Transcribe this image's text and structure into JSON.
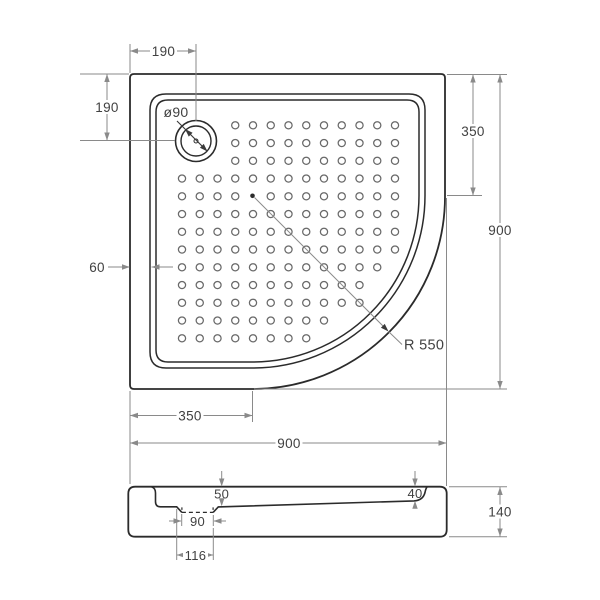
{
  "colors": {
    "background": "#ffffff",
    "object_line": "#2b2b2b",
    "dimension_line": "#8a8a8a",
    "text": "#414141",
    "dot_outline": "#696969"
  },
  "top_view": {
    "dim_top_offset": "190",
    "dim_left_offset": "190",
    "drain_label": "ø90",
    "dim_right_segment": "350",
    "dim_right_total": "900",
    "dim_rim_width": "60",
    "corner_radius_label": "R 550",
    "dim_bottom_segment": "350",
    "dim_bottom_total": "900"
  },
  "section_view": {
    "dim_depth_at_drain": "50",
    "dim_depth_at_edge": "40",
    "dim_recess_width": "90",
    "dim_recess_offset": "116",
    "dim_height": "140"
  },
  "dots": {
    "cols": 13,
    "rows": 13,
    "spacing": 17.75,
    "origin_x": 182,
    "origin_y": 125.3,
    "drain_skip_cols": 3,
    "drain_skip_rows": 3,
    "corner_center_x": 252.5,
    "corner_center_y": 195.5,
    "corner_clip_radius": 153,
    "dot_radius": 3.6,
    "center_col": 4,
    "center_row": 4
  }
}
